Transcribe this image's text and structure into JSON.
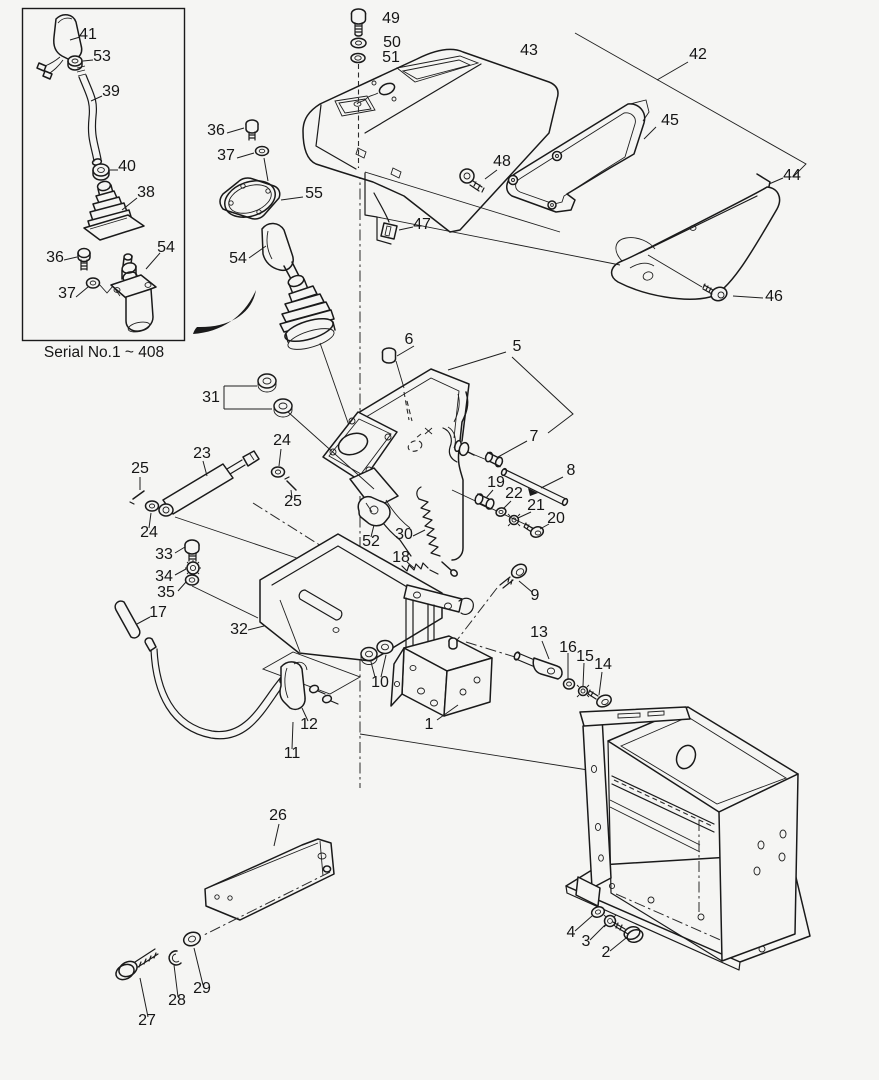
{
  "figure": {
    "kind": "exploded-parts-diagram",
    "background": "#f5f5f3",
    "ink": "#1a1a1a",
    "caption": "Serial No.1 ~ 408"
  },
  "callouts": [
    {
      "part": "41",
      "label": "41"
    },
    {
      "part": "53",
      "label": "53"
    },
    {
      "part": "39",
      "label": "39"
    },
    {
      "part": "40",
      "label": "40"
    },
    {
      "part": "38",
      "label": "38"
    },
    {
      "part": "36-inset",
      "label": "36"
    },
    {
      "part": "37-inset",
      "label": "37"
    },
    {
      "part": "54-inset",
      "label": "54"
    },
    {
      "part": "49",
      "label": "49"
    },
    {
      "part": "50",
      "label": "50"
    },
    {
      "part": "51",
      "label": "51"
    },
    {
      "part": "43",
      "label": "43"
    },
    {
      "part": "42",
      "label": "42"
    },
    {
      "part": "45",
      "label": "45"
    },
    {
      "part": "44",
      "label": "44"
    },
    {
      "part": "48",
      "label": "48"
    },
    {
      "part": "46",
      "label": "46"
    },
    {
      "part": "47",
      "label": "47"
    },
    {
      "part": "55",
      "label": "55"
    },
    {
      "part": "36-main",
      "label": "36"
    },
    {
      "part": "37-main",
      "label": "37"
    },
    {
      "part": "54-main",
      "label": "54"
    },
    {
      "part": "6",
      "label": "6"
    },
    {
      "part": "5",
      "label": "5"
    },
    {
      "part": "31",
      "label": "31"
    },
    {
      "part": "23",
      "label": "23"
    },
    {
      "part": "24-right",
      "label": "24"
    },
    {
      "part": "25-right",
      "label": "25"
    },
    {
      "part": "25-left",
      "label": "25"
    },
    {
      "part": "24-left",
      "label": "24"
    },
    {
      "part": "7",
      "label": "7"
    },
    {
      "part": "8",
      "label": "8"
    },
    {
      "part": "19",
      "label": "19"
    },
    {
      "part": "22",
      "label": "22"
    },
    {
      "part": "21",
      "label": "21"
    },
    {
      "part": "20",
      "label": "20"
    },
    {
      "part": "9",
      "label": "9"
    },
    {
      "part": "30",
      "label": "30"
    },
    {
      "part": "52",
      "label": "52"
    },
    {
      "part": "18",
      "label": "18"
    },
    {
      "part": "33",
      "label": "33"
    },
    {
      "part": "34",
      "label": "34"
    },
    {
      "part": "35",
      "label": "35"
    },
    {
      "part": "17",
      "label": "17"
    },
    {
      "part": "32",
      "label": "32"
    },
    {
      "part": "10",
      "label": "10"
    },
    {
      "part": "13",
      "label": "13"
    },
    {
      "part": "16",
      "label": "16"
    },
    {
      "part": "15",
      "label": "15"
    },
    {
      "part": "14",
      "label": "14"
    },
    {
      "part": "12",
      "label": "12"
    },
    {
      "part": "11",
      "label": "11"
    },
    {
      "part": "1",
      "label": "1"
    },
    {
      "part": "26",
      "label": "26"
    },
    {
      "part": "29",
      "label": "29"
    },
    {
      "part": "28",
      "label": "28"
    },
    {
      "part": "27",
      "label": "27"
    },
    {
      "part": "4",
      "label": "4"
    },
    {
      "part": "3",
      "label": "3"
    },
    {
      "part": "2",
      "label": "2"
    }
  ]
}
